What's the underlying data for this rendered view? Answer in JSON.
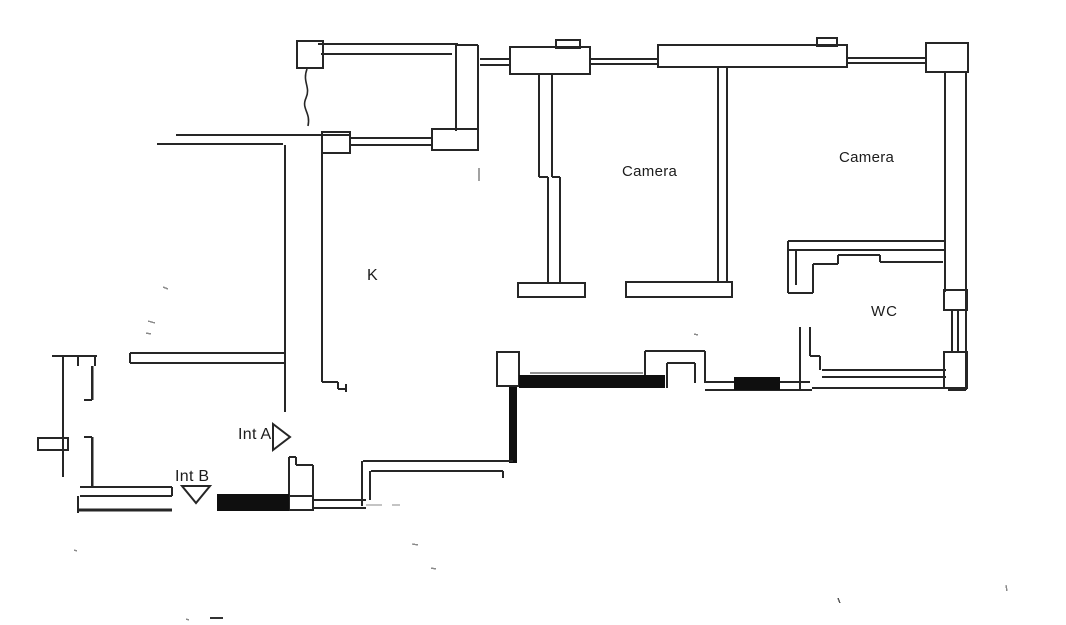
{
  "document": {
    "type": "scanned-floor-plan",
    "background_color": "#ffffff",
    "line_color": "#262626",
    "solid_wall_color": "#0f0f0f"
  },
  "floorplan": {
    "labels": {
      "camera_1": "Camera",
      "camera_2": "Camera",
      "kitchen": "K",
      "wc": "WC",
      "int_a": "Int A",
      "int_b": "Int B"
    },
    "markers": {
      "int_a_icon": "triangle-right-icon",
      "int_b_icon": "triangle-down-icon"
    },
    "features": [
      "balcony-top-left",
      "north-window-wall",
      "east-window-wall",
      "two-bedrooms-camera",
      "wc-room",
      "kitchen-corridor",
      "south-solid-walls",
      "entrance-markers-int-a-int-b"
    ]
  }
}
